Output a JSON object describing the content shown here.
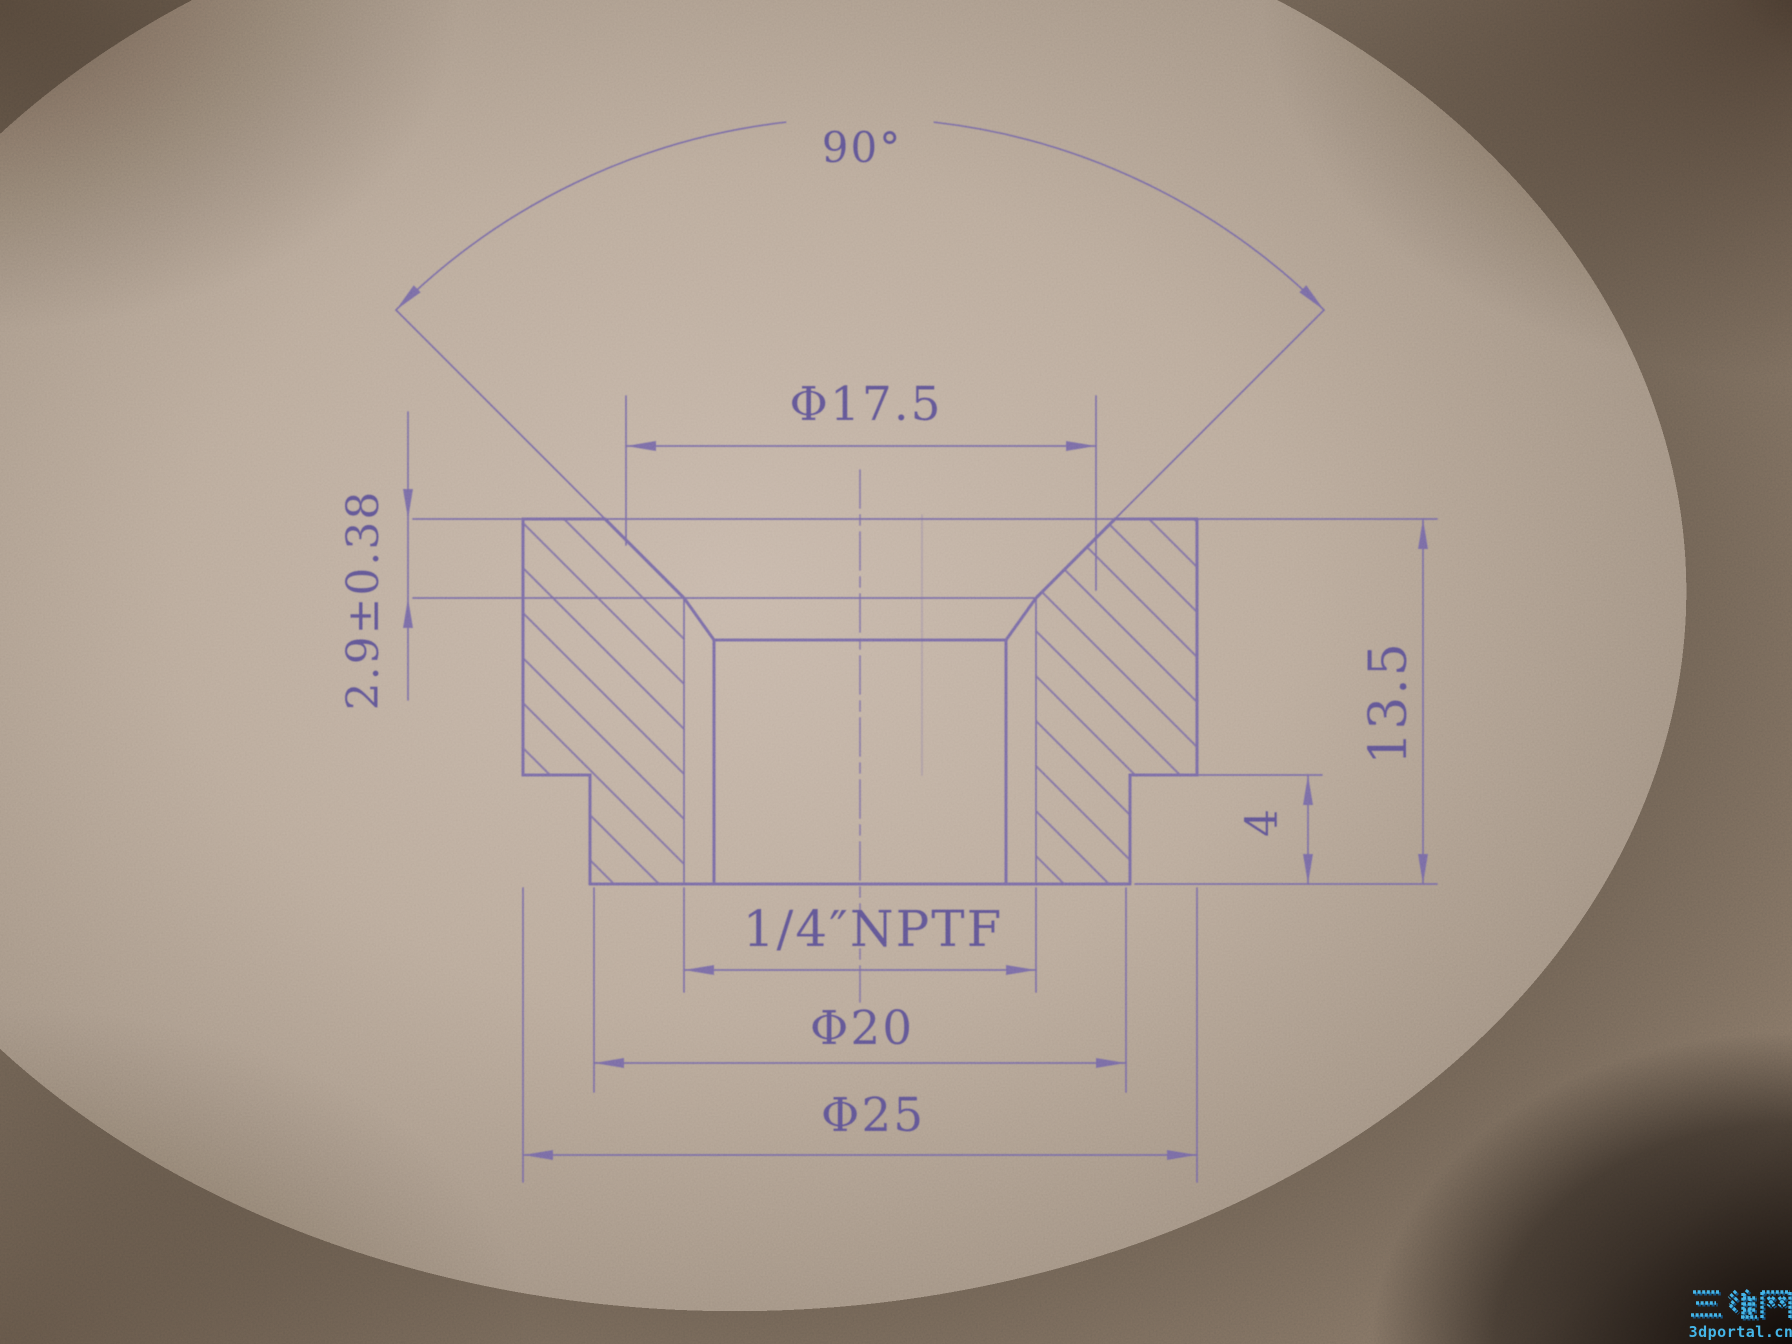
{
  "colors": {
    "ink": "#6e63a4",
    "ink_text": "#554e92",
    "watermark": "#45b6e8",
    "watermark_shadow": "#175f94"
  },
  "labels": {
    "countersink_angle": "90°",
    "countersink_diameter": "Φ17.5",
    "countersink_depth": "2.9±0.38",
    "overall_height": "13.5",
    "boss_height": "4",
    "thread_spec": "1/4″NPTF",
    "boss_diameter": "Φ20",
    "outer_diameter": "Φ25"
  },
  "watermark": {
    "site_name_cjk": "三维网",
    "site_domain": "3dportal.cn"
  }
}
